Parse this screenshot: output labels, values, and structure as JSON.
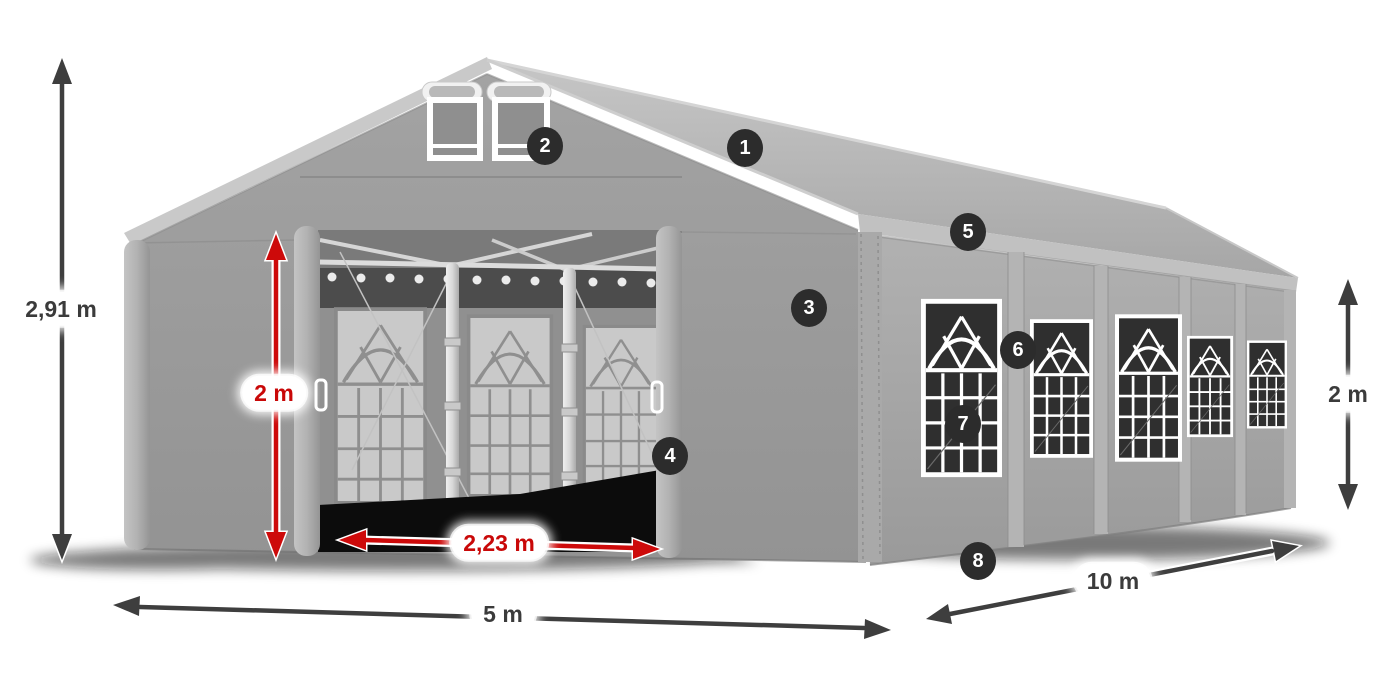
{
  "dimensions": {
    "total_height": {
      "label": "2,91 m",
      "style": "dark"
    },
    "door_height": {
      "label": "2 m",
      "style": "red"
    },
    "door_width": {
      "label": "2,23 m",
      "style": "red"
    },
    "front_width": {
      "label": "5 m",
      "style": "dark"
    },
    "side_length": {
      "label": "10 m",
      "style": "dark"
    },
    "side_height": {
      "label": "2 m",
      "style": "dark"
    }
  },
  "callouts": [
    {
      "number": "1"
    },
    {
      "number": "2"
    },
    {
      "number": "3"
    },
    {
      "number": "4"
    },
    {
      "number": "5"
    },
    {
      "number": "6"
    },
    {
      "number": "7"
    },
    {
      "number": "8"
    }
  ],
  "colors": {
    "dimension_red": "#cd0a0a",
    "dimension_dark": "#3e3e3e",
    "badge_background": "#2c2c2c",
    "badge_text": "#ffffff",
    "label_background": "#ffffff",
    "tent_roof": "#b9b9b9",
    "tent_wall": "#9d9d9d",
    "window_mesh": "#2f2f2f"
  }
}
